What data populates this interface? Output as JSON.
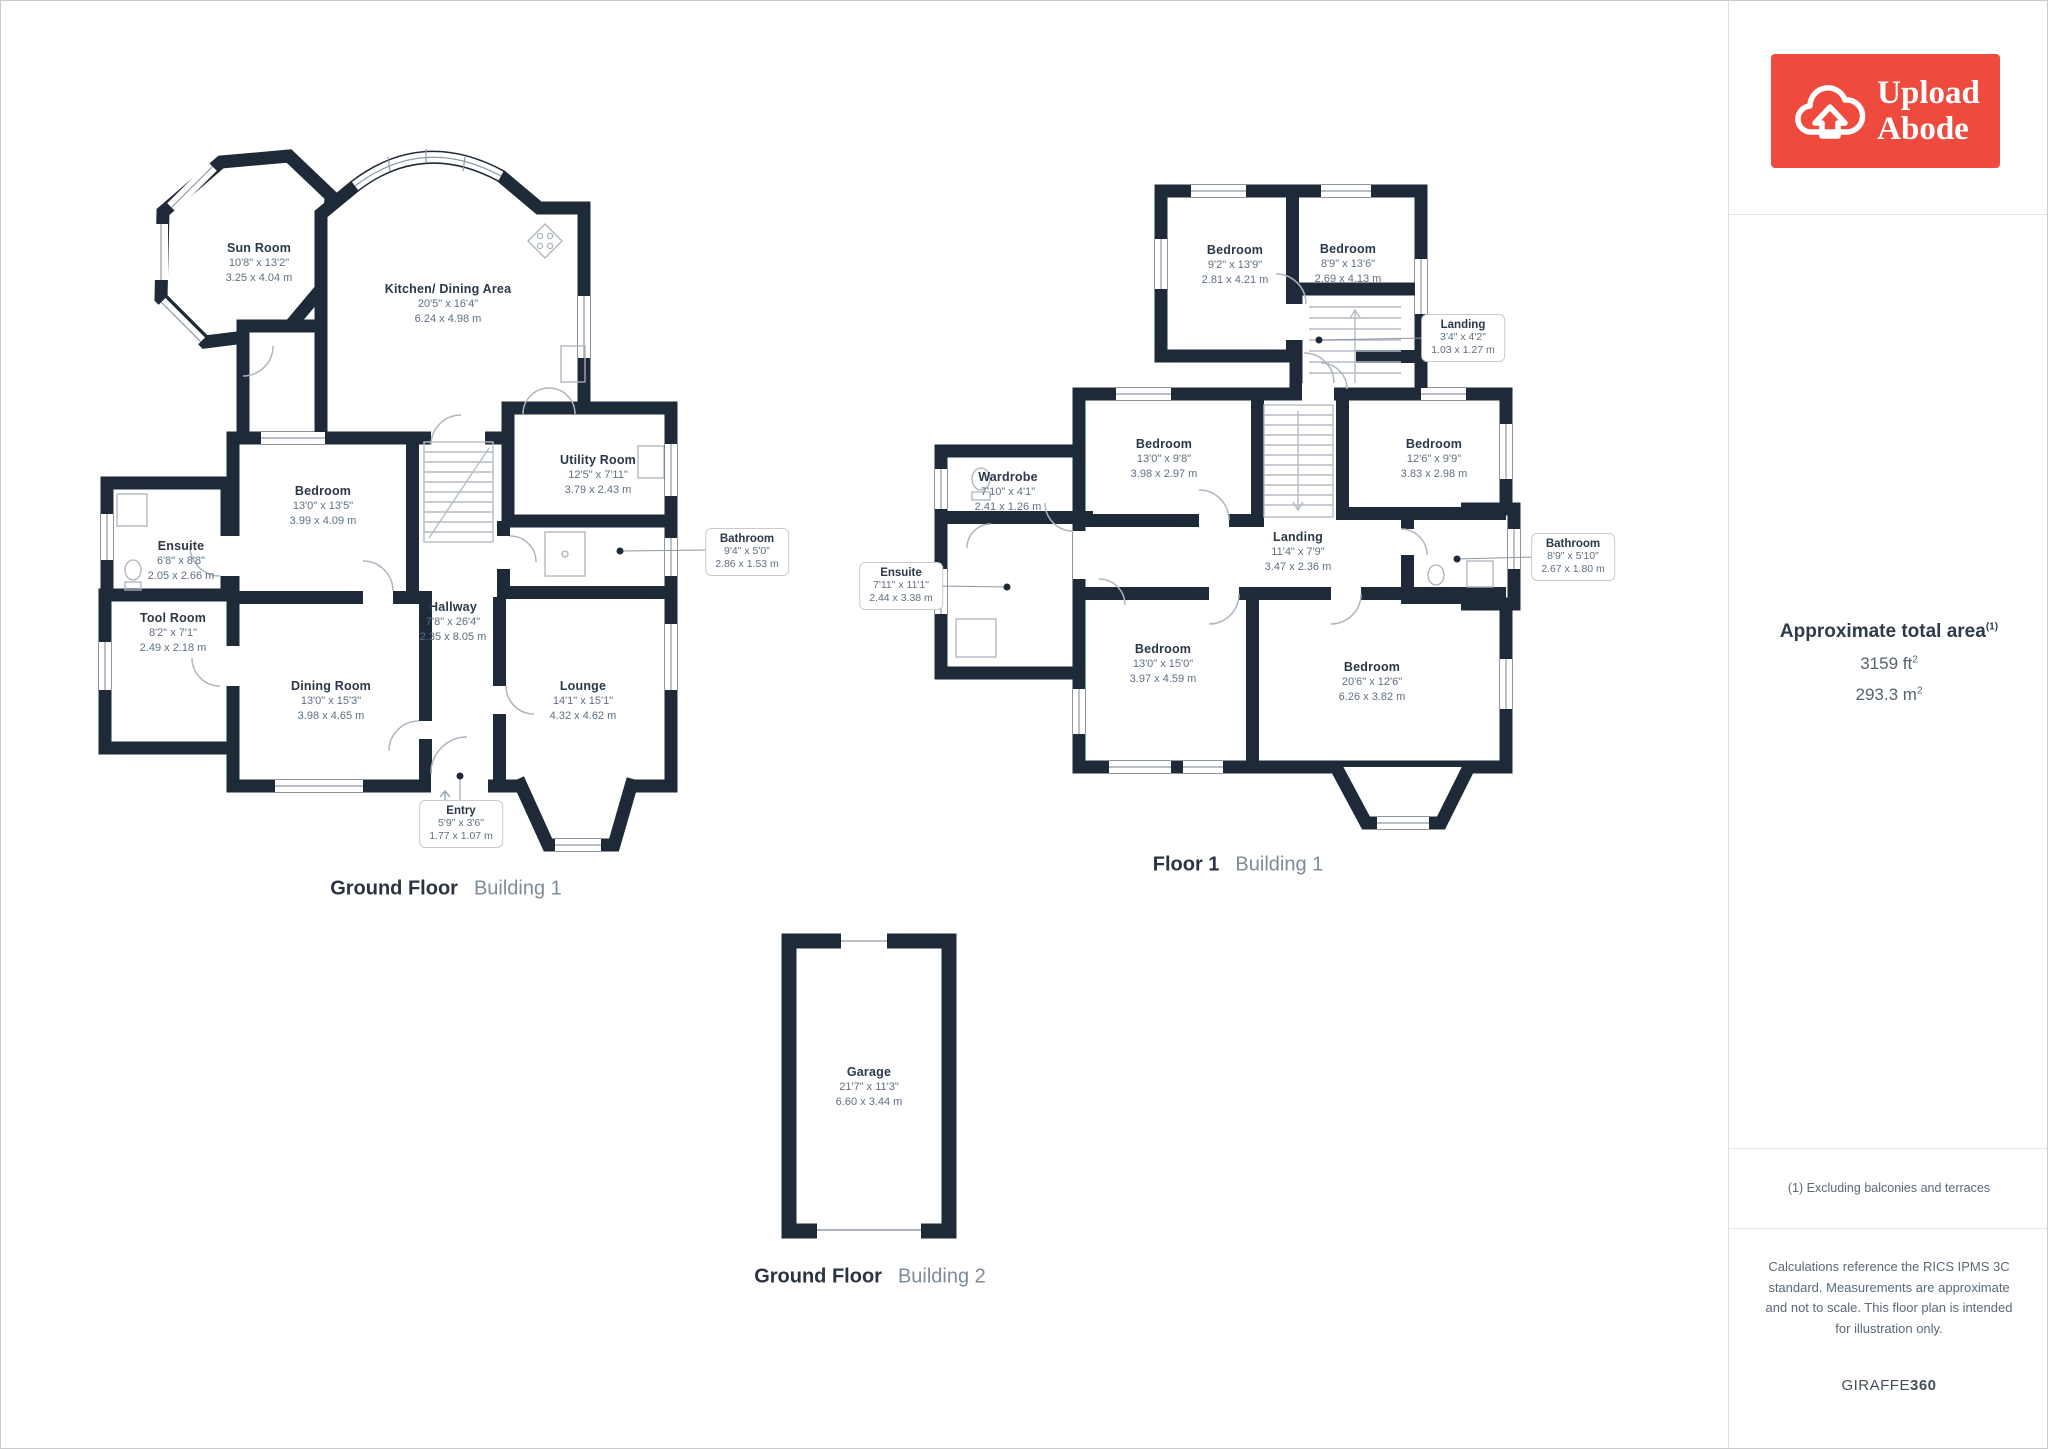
{
  "colors": {
    "wall": "#1f2a38",
    "logo_red": "#ef4a3e",
    "room_title": "#2b3847",
    "room_dims": "#5d6f82",
    "caption_light": "#7e8b99"
  },
  "floors": [
    {
      "caption_bold": "Ground Floor",
      "caption_light": "Building 1",
      "rooms": [
        {
          "name": "Sun Room",
          "imperial": "10'8\" x 13'2\"",
          "metric": "3.25 x 4.04 m"
        },
        {
          "name": "Kitchen/ Dining Area",
          "imperial": "20'5\" x 16'4\"",
          "metric": "6.24 x 4.98 m"
        },
        {
          "name": "Bedroom",
          "imperial": "13'0\" x 13'5\"",
          "metric": "3.99 x 4.09 m"
        },
        {
          "name": "Utility Room",
          "imperial": "12'5\" x 7'11\"",
          "metric": "3.79 x 2.43 m"
        },
        {
          "name": "Ensuite",
          "imperial": "6'8\" x 8'8\"",
          "metric": "2.05 x 2.66 m"
        },
        {
          "name": "Tool Room",
          "imperial": "8'2\" x 7'1\"",
          "metric": "2.49 x 2.18 m"
        },
        {
          "name": "Hallway",
          "imperial": "7'8\" x 26'4\"",
          "metric": "2.35 x 8.05 m"
        },
        {
          "name": "Dining Room",
          "imperial": "13'0\" x 15'3\"",
          "metric": "3.98 x 4.65 m"
        },
        {
          "name": "Lounge",
          "imperial": "14'1\" x 15'1\"",
          "metric": "4.32 x 4.62 m"
        },
        {
          "name": "Bathroom",
          "imperial": "9'4\" x 5'0\"",
          "metric": "2.86 x 1.53 m"
        },
        {
          "name": "Entry",
          "imperial": "5'9\" x 3'6\"",
          "metric": "1.77 x 1.07 m"
        }
      ]
    },
    {
      "caption_bold": "Floor 1",
      "caption_light": "Building 1",
      "rooms": [
        {
          "name": "Bedroom",
          "imperial": "9'2\" x 13'9\"",
          "metric": "2.81 x 4.21 m"
        },
        {
          "name": "Bedroom",
          "imperial": "8'9\" x 13'6\"",
          "metric": "2.69 x 4.13 m"
        },
        {
          "name": "Landing",
          "imperial": "3'4\" x 4'2\"",
          "metric": "1.03 x 1.27 m"
        },
        {
          "name": "Bedroom",
          "imperial": "13'0\" x 9'8\"",
          "metric": "3.98 x 2.97 m"
        },
        {
          "name": "Bedroom",
          "imperial": "12'6\" x 9'9\"",
          "metric": "3.83 x 2.98 m"
        },
        {
          "name": "Wardrobe",
          "imperial": "7'10\" x 4'1\"",
          "metric": "2.41 x 1.26 m"
        },
        {
          "name": "Ensuite",
          "imperial": "7'11\" x 11'1\"",
          "metric": "2.44 x 3.38 m"
        },
        {
          "name": "Landing",
          "imperial": "11'4\" x 7'9\"",
          "metric": "3.47 x 2.36 m"
        },
        {
          "name": "Bathroom",
          "imperial": "8'9\" x 5'10\"",
          "metric": "2.67 x 1.80 m"
        },
        {
          "name": "Bedroom",
          "imperial": "13'0\" x 15'0\"",
          "metric": "3.97 x 4.59 m"
        },
        {
          "name": "Bedroom",
          "imperial": "20'6\" x 12'6\"",
          "metric": "6.26 x 3.82 m"
        }
      ]
    },
    {
      "caption_bold": "Ground Floor",
      "caption_light": "Building 2",
      "rooms": [
        {
          "name": "Garage",
          "imperial": "21'7\" x 11'3\"",
          "metric": "6.60 x 3.44 m"
        }
      ]
    }
  ],
  "sidebar": {
    "logo_line1": "Upload",
    "logo_line2": "Abode",
    "area_title": "Approximate total area",
    "area_title_sup": "(1)",
    "area_sqft": "3159 ft",
    "area_sqft_sup": "2",
    "area_sqm": "293.3 m",
    "area_sqm_sup": "2",
    "footnote": "(1) Excluding balconies and terraces",
    "disclaimer": "Calculations reference the RICS IPMS 3C standard. Measurements are approximate and not to scale. This floor plan is intended for illustration only.",
    "brand_name": "GIRAFFE",
    "brand_suffix": "360"
  }
}
